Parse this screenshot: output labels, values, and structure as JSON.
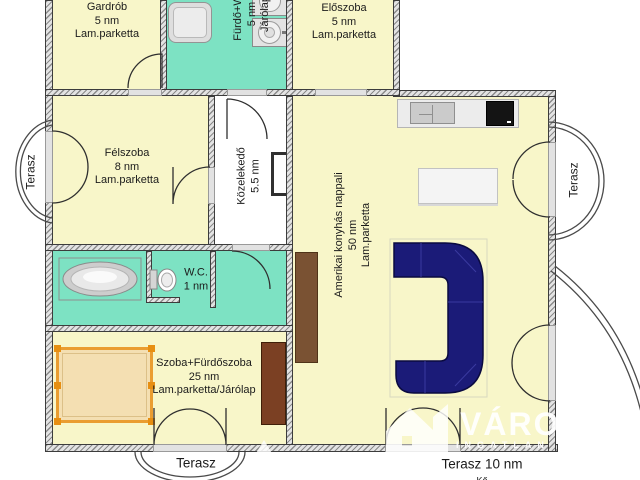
{
  "rooms": {
    "gardrob": {
      "name": "Gardrób",
      "area": "5 nm",
      "floor": "Lam.parketta"
    },
    "furdo": {
      "name": "Fürdő+WC",
      "area": "5 nm",
      "floor": "Járólap"
    },
    "eloszoba": {
      "name": "Előszoba",
      "area": "5 nm",
      "floor": "Lam.parketta"
    },
    "felszoba": {
      "name": "Félszoba",
      "area": "8 nm",
      "floor": "Lam.parketta"
    },
    "kozlekedo": {
      "name": "Közelekedő",
      "area": "5.5 nm"
    },
    "nappali": {
      "name": "Amerikai konyhás nappali",
      "area": "50 nm",
      "floor": "Lam.parketta"
    },
    "wc": {
      "name": "W.C.",
      "area": "1 nm"
    },
    "szoba": {
      "name": "Szoba+Fürdőszoba",
      "area": "25 nm",
      "floor": "Lam.parketta/Járólap"
    }
  },
  "terraces": {
    "left": "Terasz",
    "right": "Terasz",
    "bottom": "Terasz",
    "bottom_right": "Terasz 10 nm",
    "bottom_right_floor": "Kő"
  },
  "watermark": {
    "brand": "VÁRO",
    "subtitle": "INGATLAN"
  },
  "colors": {
    "room_fill": "#F8F6C9",
    "wet_room_fill": "#7DE2C3",
    "wall": "#3C3C3C",
    "sofa_navy": "#1B1B78",
    "bed_frame_orange": "#EA9D31",
    "wood_brown": "#7A4A28"
  }
}
